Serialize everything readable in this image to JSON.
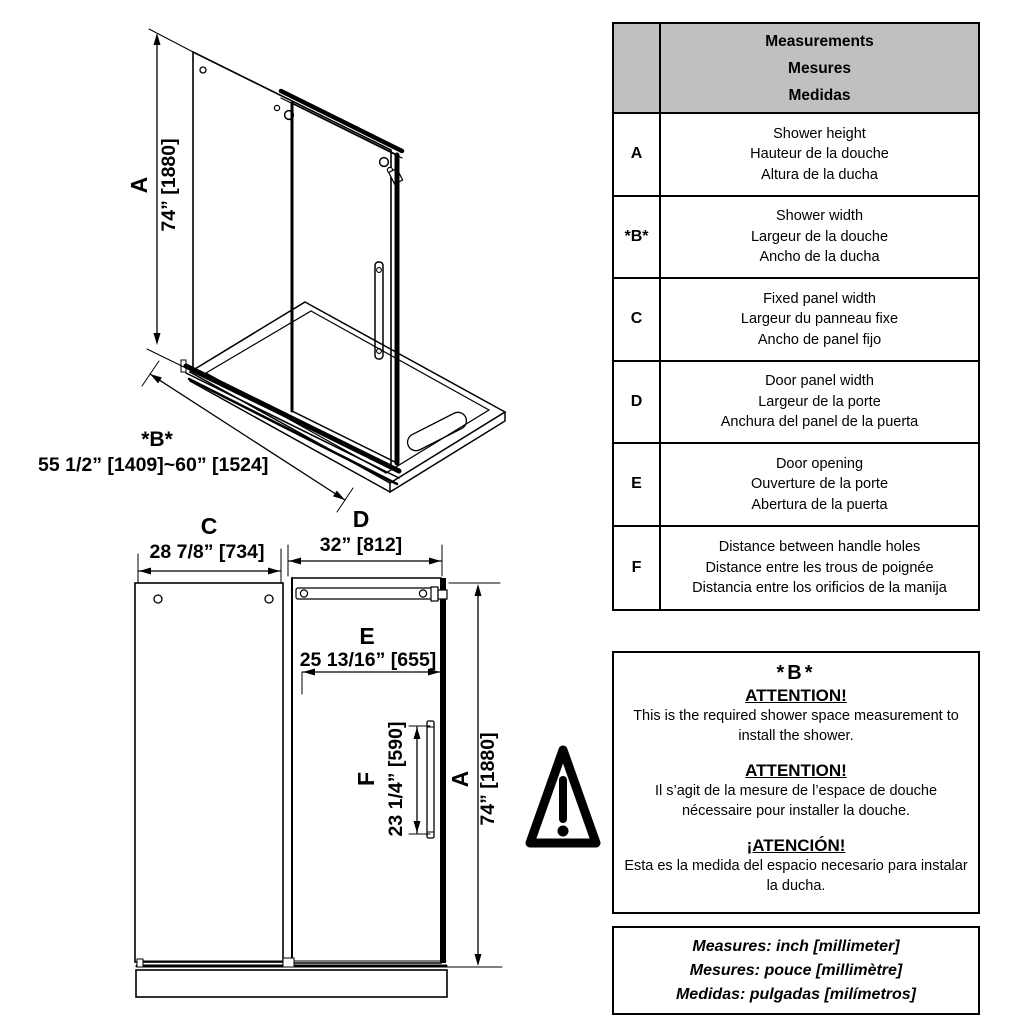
{
  "colors": {
    "line": "#000000",
    "table_header_bg": "#c0c0c0",
    "background": "#ffffff"
  },
  "perspective_view": {
    "dim_a": {
      "letter": "A",
      "value": "74” [1880]"
    },
    "dim_b": {
      "letter": "*B*",
      "value": "55 1/2” [1409]~60” [1524]"
    }
  },
  "front_view": {
    "dim_c": {
      "letter": "C",
      "value": "28 7/8” [734]"
    },
    "dim_d": {
      "letter": "D",
      "value": "32” [812]"
    },
    "dim_e": {
      "letter": "E",
      "value": "25 13/16” [655]"
    },
    "dim_f": {
      "letter": "F",
      "value": "23 1/4” [590]"
    },
    "dim_a": {
      "letter": "A",
      "value": "74” [1880]"
    }
  },
  "measurements_table": {
    "header_lines": [
      "Measurements",
      "Mesures",
      "Medidas"
    ],
    "rows": [
      {
        "key": "A",
        "lines": [
          "Shower height",
          "Hauteur de la douche",
          "Altura de la ducha"
        ]
      },
      {
        "key": "*B*",
        "lines": [
          "Shower width",
          "Largeur de la douche",
          "Ancho de la ducha"
        ]
      },
      {
        "key": "C",
        "lines": [
          "Fixed panel width",
          "Largeur du panneau fixe",
          "Ancho de panel fijo"
        ]
      },
      {
        "key": "D",
        "lines": [
          "Door panel width",
          "Largeur de la porte",
          "Anchura del panel de la puerta"
        ]
      },
      {
        "key": "E",
        "lines": [
          "Door opening",
          "Ouverture de la porte",
          "Abertura de la puerta"
        ]
      },
      {
        "key": "F",
        "lines": [
          "Distance between handle holes",
          "Distance entre les trous de poignée",
          "Distancia entre los orificios de la manija"
        ]
      }
    ]
  },
  "attention_box": {
    "title": "*B*",
    "sections": [
      {
        "heading": "ATTENTION!",
        "body": "This is the required shower space measurement to install the shower."
      },
      {
        "heading": "ATTENTION!",
        "body": "Il s’agit de la mesure de l’espace de douche nécessaire pour installer la douche."
      },
      {
        "heading": "¡ATENCIÓN!",
        "body": "Esta es la medida del espacio necesario para instalar la ducha."
      }
    ]
  },
  "units_box": {
    "lines": [
      "Measures: inch [millimeter]",
      "Mesures: pouce [millimètre]",
      "Medidas: pulgadas [milímetros]"
    ]
  }
}
